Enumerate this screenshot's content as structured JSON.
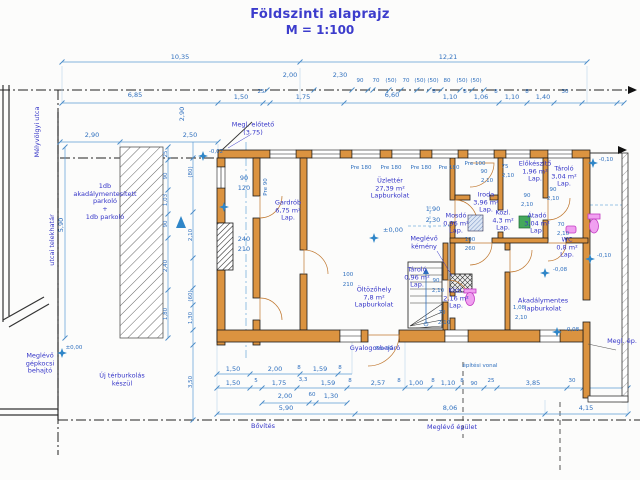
{
  "title": {
    "line1": "Földszinti alaprajz",
    "line2": "M = 1:100"
  },
  "colors": {
    "accent_blue": "#2e6fbe",
    "label_indigo": "#3535c8",
    "wall_orange": "#db9340",
    "fixture_magenta": "#c23ac2",
    "fixture_green": "#44a85c",
    "level_star": "#2f86c8"
  },
  "labels": [
    {
      "t": "10,35",
      "x": 180,
      "y": 58,
      "c": "dim"
    },
    {
      "t": "12,21",
      "x": 448,
      "y": 58,
      "c": "dim"
    },
    {
      "t": "2,00",
      "x": 290,
      "y": 76,
      "c": "dim"
    },
    {
      "t": "2,30",
      "x": 340,
      "y": 76,
      "c": "dim"
    },
    {
      "t": "90",
      "x": 360,
      "y": 81,
      "c": "dims"
    },
    {
      "t": "70",
      "x": 376,
      "y": 81,
      "c": "dims"
    },
    {
      "t": "(50)",
      "x": 391,
      "y": 81,
      "c": "dims"
    },
    {
      "t": "70",
      "x": 406,
      "y": 81,
      "c": "dims"
    },
    {
      "t": "(50)",
      "x": 420,
      "y": 81,
      "c": "dims"
    },
    {
      "t": "(50)",
      "x": 433,
      "y": 81,
      "c": "dims"
    },
    {
      "t": "80",
      "x": 447,
      "y": 81,
      "c": "dims"
    },
    {
      "t": "(50)",
      "x": 462,
      "y": 81,
      "c": "dims"
    },
    {
      "t": "(50)",
      "x": 476,
      "y": 81,
      "c": "dims"
    },
    {
      "t": "6,85",
      "x": 135,
      "y": 96,
      "c": "dim"
    },
    {
      "t": "1,50",
      "x": 241,
      "y": 98,
      "c": "dim"
    },
    {
      "t": "25",
      "x": 261,
      "y": 92,
      "c": "dims"
    },
    {
      "t": "1,75",
      "x": 303,
      "y": 98,
      "c": "dim"
    },
    {
      "t": "6,60",
      "x": 392,
      "y": 96,
      "c": "dim"
    },
    {
      "t": "8",
      "x": 434,
      "y": 92,
      "c": "dims"
    },
    {
      "t": "1,10",
      "x": 450,
      "y": 98,
      "c": "dim"
    },
    {
      "t": "8",
      "x": 465,
      "y": 92,
      "c": "dims"
    },
    {
      "t": "1,06",
      "x": 481,
      "y": 98,
      "c": "dim"
    },
    {
      "t": "8",
      "x": 496,
      "y": 92,
      "c": "dims"
    },
    {
      "t": "1,10",
      "x": 512,
      "y": 98,
      "c": "dim"
    },
    {
      "t": "8",
      "x": 527,
      "y": 92,
      "c": "dims"
    },
    {
      "t": "1,40",
      "x": 543,
      "y": 98,
      "c": "dim"
    },
    {
      "t": "30",
      "x": 565,
      "y": 92,
      "c": "dims"
    },
    {
      "t": "2,90",
      "x": 92,
      "y": 136,
      "c": "dim"
    },
    {
      "t": "2,50",
      "x": 190,
      "y": 136,
      "c": "dim"
    },
    {
      "t": "2,90",
      "x": 183,
      "y": 114,
      "c": "dim",
      "r": 1
    },
    {
      "t": "5,90",
      "x": 62,
      "y": 225,
      "c": "dim",
      "r": 1
    },
    {
      "t": "25",
      "x": 166,
      "y": 154,
      "c": "dims",
      "r": 1
    },
    {
      "t": "90",
      "x": 166,
      "y": 176,
      "c": "dims",
      "r": 1
    },
    {
      "t": "1,03",
      "x": 166,
      "y": 200,
      "c": "dims",
      "r": 1
    },
    {
      "t": "90",
      "x": 166,
      "y": 224,
      "c": "dims",
      "r": 1
    },
    {
      "t": "2,40",
      "x": 166,
      "y": 266,
      "c": "dims",
      "r": 1
    },
    {
      "t": "1,80",
      "x": 166,
      "y": 314,
      "c": "dims",
      "r": 1
    },
    {
      "t": "(80)",
      "x": 191,
      "y": 172,
      "c": "dims",
      "r": 1
    },
    {
      "t": "2,10",
      "x": 191,
      "y": 235,
      "c": "dims",
      "r": 1
    },
    {
      "t": "(60)",
      "x": 191,
      "y": 296,
      "c": "dims",
      "r": 1
    },
    {
      "t": "1,30",
      "x": 191,
      "y": 318,
      "c": "dims",
      "r": 1
    },
    {
      "t": "3,50",
      "x": 191,
      "y": 382,
      "c": "dims",
      "r": 1
    },
    {
      "t": "90",
      "x": 244,
      "y": 179,
      "c": "dim"
    },
    {
      "t": "120",
      "x": 244,
      "y": 189,
      "c": "dim"
    },
    {
      "t": "240",
      "x": 244,
      "y": 240,
      "c": "dim"
    },
    {
      "t": "210",
      "x": 244,
      "y": 250,
      "c": "dim"
    },
    {
      "t": "Pre 90",
      "x": 266,
      "y": 187,
      "c": "dims",
      "r": 1
    },
    {
      "t": "Pre 180",
      "x": 361,
      "y": 168,
      "c": "dims"
    },
    {
      "t": "Pre 180",
      "x": 391,
      "y": 168,
      "c": "dims"
    },
    {
      "t": "Pre 180",
      "x": 421,
      "y": 168,
      "c": "dims"
    },
    {
      "t": "Pre 180",
      "x": 449,
      "y": 168,
      "c": "dims"
    },
    {
      "t": "Pre 100",
      "x": 475,
      "y": 164,
      "c": "dims"
    },
    {
      "t": "90",
      "x": 484,
      "y": 172,
      "c": "dims"
    },
    {
      "t": "2,10",
      "x": 487,
      "y": 181,
      "c": "dims"
    },
    {
      "t": "75",
      "x": 505,
      "y": 167,
      "c": "dims"
    },
    {
      "t": "2,10",
      "x": 508,
      "y": 176,
      "c": "dims"
    },
    {
      "t": "90",
      "x": 527,
      "y": 196,
      "c": "dims"
    },
    {
      "t": "2,10",
      "x": 527,
      "y": 205,
      "c": "dims"
    },
    {
      "t": "90",
      "x": 553,
      "y": 190,
      "c": "dims"
    },
    {
      "t": "2,10",
      "x": 553,
      "y": 199,
      "c": "dims"
    },
    {
      "t": "70",
      "x": 561,
      "y": 225,
      "c": "dims"
    },
    {
      "t": "2,10",
      "x": 563,
      "y": 234,
      "c": "dims"
    },
    {
      "t": "1,90",
      "x": 433,
      "y": 210,
      "c": "dim"
    },
    {
      "t": "2,30",
      "x": 433,
      "y": 221,
      "c": "dim"
    },
    {
      "t": "100",
      "x": 470,
      "y": 240,
      "c": "dims"
    },
    {
      "t": "260",
      "x": 470,
      "y": 249,
      "c": "dims"
    },
    {
      "t": "100",
      "x": 348,
      "y": 275,
      "c": "dims"
    },
    {
      "t": "210",
      "x": 348,
      "y": 285,
      "c": "dims"
    },
    {
      "t": "90",
      "x": 436,
      "y": 281,
      "c": "dims"
    },
    {
      "t": "2,10",
      "x": 438,
      "y": 291,
      "c": "dims"
    },
    {
      "t": "1,08",
      "x": 519,
      "y": 308,
      "c": "dims"
    },
    {
      "t": "2,10",
      "x": 521,
      "y": 318,
      "c": "dims"
    },
    {
      "t": "70",
      "x": 442,
      "y": 313,
      "c": "dims"
    },
    {
      "t": "2,10",
      "x": 444,
      "y": 323,
      "c": "dims"
    },
    {
      "t": "Pre 90",
      "x": 384,
      "y": 349,
      "c": "dims"
    },
    {
      "t": "1,50",
      "x": 233,
      "y": 370,
      "c": "dim"
    },
    {
      "t": "2,00",
      "x": 275,
      "y": 370,
      "c": "dim"
    },
    {
      "t": "8",
      "x": 299,
      "y": 368,
      "c": "dims"
    },
    {
      "t": "1,59",
      "x": 320,
      "y": 370,
      "c": "dim"
    },
    {
      "t": "8",
      "x": 340,
      "y": 368,
      "c": "dims"
    },
    {
      "t": "1,50",
      "x": 233,
      "y": 384,
      "c": "dim"
    },
    {
      "t": "5",
      "x": 256,
      "y": 381,
      "c": "dims"
    },
    {
      "t": "1,75",
      "x": 279,
      "y": 384,
      "c": "dim"
    },
    {
      "t": "3,3",
      "x": 303,
      "y": 380,
      "c": "dims"
    },
    {
      "t": "1,59",
      "x": 328,
      "y": 384,
      "c": "dim"
    },
    {
      "t": "8",
      "x": 350,
      "y": 381,
      "c": "dims"
    },
    {
      "t": "2,57",
      "x": 378,
      "y": 384,
      "c": "dim"
    },
    {
      "t": "8",
      "x": 399,
      "y": 381,
      "c": "dims"
    },
    {
      "t": "1,00",
      "x": 416,
      "y": 384,
      "c": "dim"
    },
    {
      "t": "8",
      "x": 433,
      "y": 381,
      "c": "dims"
    },
    {
      "t": "1,10",
      "x": 448,
      "y": 384,
      "c": "dim"
    },
    {
      "t": "8",
      "x": 462,
      "y": 381,
      "c": "dims"
    },
    {
      "t": "90",
      "x": 474,
      "y": 384,
      "c": "dims"
    },
    {
      "t": "25",
      "x": 491,
      "y": 381,
      "c": "dims"
    },
    {
      "t": "3,85",
      "x": 533,
      "y": 384,
      "c": "dim"
    },
    {
      "t": "30",
      "x": 572,
      "y": 381,
      "c": "dims"
    },
    {
      "t": "2,00",
      "x": 285,
      "y": 397,
      "c": "dim"
    },
    {
      "t": "60",
      "x": 312,
      "y": 395,
      "c": "dims"
    },
    {
      "t": "1,30",
      "x": 331,
      "y": 397,
      "c": "dim"
    },
    {
      "t": "5,90",
      "x": 286,
      "y": 409,
      "c": "dim"
    },
    {
      "t": "8,06",
      "x": 450,
      "y": 409,
      "c": "dim"
    },
    {
      "t": "4,15",
      "x": 586,
      "y": 409,
      "c": "dim"
    },
    {
      "t": "±0,00",
      "x": 393,
      "y": 231,
      "c": "dim"
    },
    {
      "t": "-0,02",
      "x": 216,
      "y": 152,
      "c": "dims"
    },
    {
      "t": "-0,08",
      "x": 560,
      "y": 270,
      "c": "dims"
    },
    {
      "t": "-0,08",
      "x": 572,
      "y": 330,
      "c": "dims"
    },
    {
      "t": "-0,10",
      "x": 606,
      "y": 160,
      "c": "dims"
    },
    {
      "t": "-0,10",
      "x": 604,
      "y": 256,
      "c": "dims"
    },
    {
      "t": "±0,00",
      "x": 74,
      "y": 348,
      "c": "dims"
    },
    {
      "t": "Üzlettér\n27,39 m²\nLapburkolat",
      "x": 390,
      "y": 189,
      "c": "room"
    },
    {
      "t": "Gardrób\n6,75 m²\nLap.",
      "x": 288,
      "y": 211,
      "c": "room"
    },
    {
      "t": "Öltözőhely\n7,8 m²\nLapburkolat",
      "x": 374,
      "y": 298,
      "c": "room"
    },
    {
      "t": "Iroda\n3,96 m²\nLap.",
      "x": 486,
      "y": 203,
      "c": "room"
    },
    {
      "t": "Mosdó\n0,96 m²\nLap.",
      "x": 456,
      "y": 224,
      "c": "room"
    },
    {
      "t": "Közl.\n4,3 m²\nLap.",
      "x": 503,
      "y": 221,
      "c": "room"
    },
    {
      "t": "Előkészítő\n1,96 m²\nLap.",
      "x": 535,
      "y": 172,
      "c": "room"
    },
    {
      "t": "Tároló\n3,04 m²\nLap.",
      "x": 564,
      "y": 177,
      "c": "room"
    },
    {
      "t": "Átadó\n3,04 m²\nLap.",
      "x": 537,
      "y": 224,
      "c": "room"
    },
    {
      "t": "WC\n0,8 m²\nLap.",
      "x": 567,
      "y": 248,
      "c": "room"
    },
    {
      "t": "Tároló\n0,96 m²\nLap.",
      "x": 417,
      "y": 278,
      "c": "room"
    },
    {
      "t": "Közl.\n2,16 m²\nLap.",
      "x": 456,
      "y": 299,
      "c": "room"
    },
    {
      "t": "Akadálymentes\nlapburkolat",
      "x": 543,
      "y": 305,
      "c": "room"
    },
    {
      "t": "Meglévő\nkémény",
      "x": 424,
      "y": 243,
      "c": "note"
    },
    {
      "t": "Megl. előtető\n(3,75)",
      "x": 253,
      "y": 129,
      "c": "note"
    },
    {
      "t": "Meglévő\ngépkocsi\nbehajtó",
      "x": 40,
      "y": 364,
      "c": "note"
    },
    {
      "t": "Új térburkolás\nkészül",
      "x": 122,
      "y": 380,
      "c": "note"
    },
    {
      "t": "Gyalogosbejáró",
      "x": 375,
      "y": 349,
      "c": "note"
    },
    {
      "t": "Bővítés",
      "x": 263,
      "y": 427,
      "c": "note"
    },
    {
      "t": "Meglévő épület",
      "x": 452,
      "y": 428,
      "c": "note"
    },
    {
      "t": "építési vonal",
      "x": 480,
      "y": 366,
      "c": "dims"
    },
    {
      "t": "Megl. ép.",
      "x": 622,
      "y": 342,
      "c": "note"
    },
    {
      "t": "1db\nakadálymentesített\nparkoló\n+\n1db parkoló",
      "x": 105,
      "y": 202,
      "c": "note"
    },
    {
      "t": "Mélyvölgyi utca",
      "x": 38,
      "y": 132,
      "c": "note",
      "r": 1
    },
    {
      "t": "utcai telekhatár",
      "x": 53,
      "y": 240,
      "c": "note",
      "r": 1
    }
  ]
}
